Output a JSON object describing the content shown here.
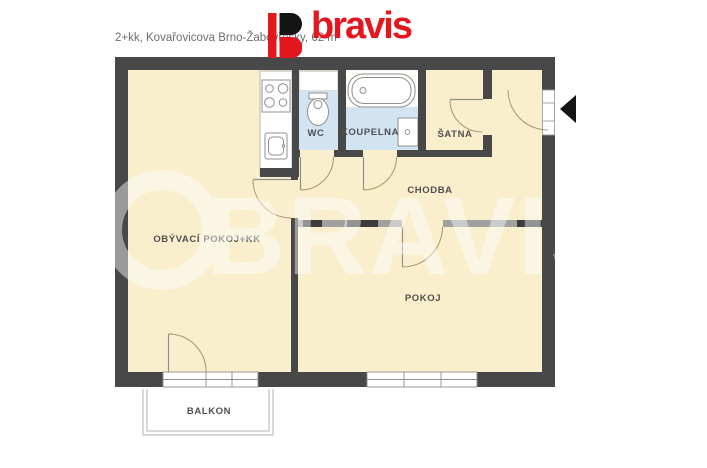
{
  "header": {
    "title": "2+kk, Kovařovicova Brno-Žabovřesky, 62 m²",
    "logo_text": "bravis"
  },
  "watermark": {
    "text": "BRAVIS"
  },
  "floorplan": {
    "rooms": [
      {
        "id": "living-room-kitchenette",
        "label": "OBÝVACÍ POKOJ+KK"
      },
      {
        "id": "wc",
        "label": "WC"
      },
      {
        "id": "bathroom",
        "label": "KOUPELNA"
      },
      {
        "id": "closet",
        "label": "ŠATNA"
      },
      {
        "id": "hallway",
        "label": "CHODBA"
      },
      {
        "id": "bedroom",
        "label": "POKOJ"
      },
      {
        "id": "balcony",
        "label": "BALKON"
      }
    ],
    "fixtures": [
      "stove",
      "kitchen-sink",
      "toilet",
      "bathtub",
      "washing-machine"
    ],
    "colors": {
      "wall": "#484848",
      "floor": "#f9efcc",
      "wet_room_floor": "#d2e4f2",
      "partition_wall": "#a0a0a0",
      "door_arc": "#a6956a",
      "label_text": "#4f4f4f",
      "logo_red": "#e4161e"
    }
  }
}
